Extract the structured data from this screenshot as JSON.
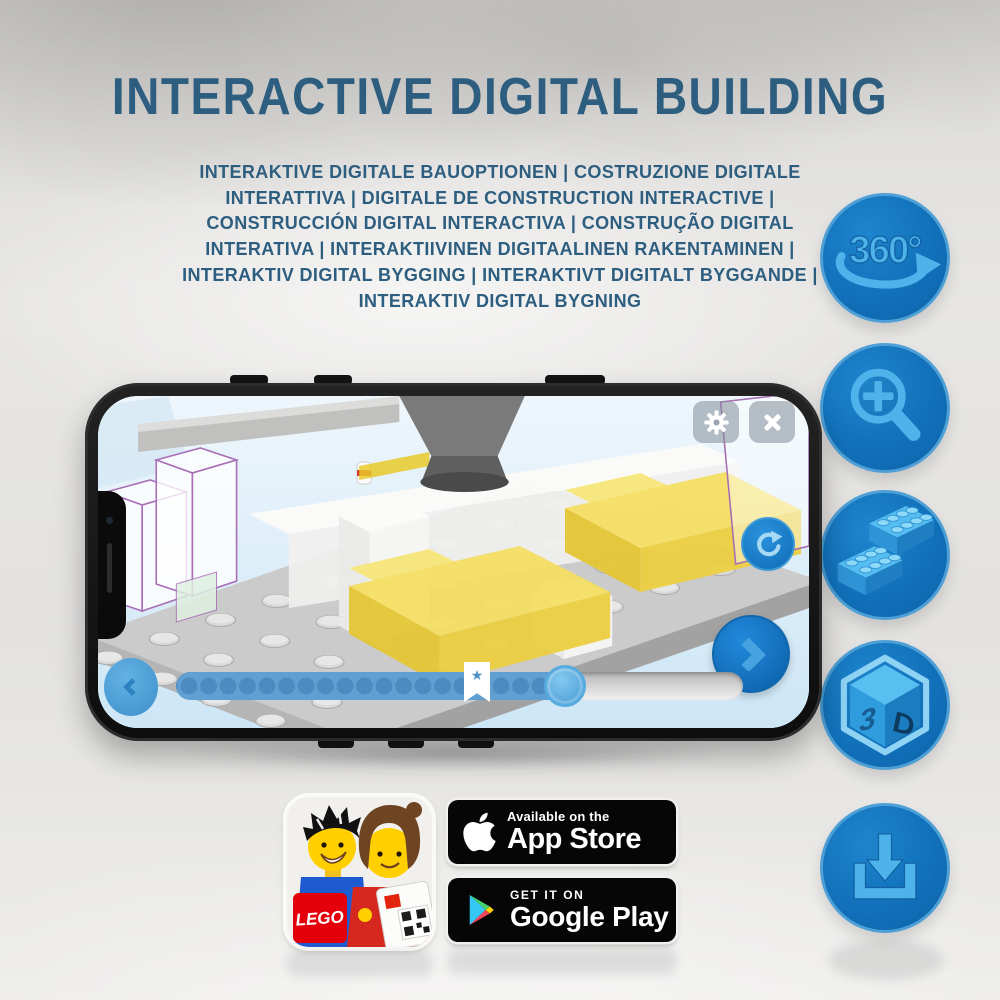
{
  "page": {
    "title": "INTERACTIVE DIGITAL BUILDING",
    "subtitle": "INTERAKTIVE DIGITALE BAUOPTIONEN | COSTRUZIONE DIGITALE INTERATTIVA | DIGITALE DE CONSTRUCTION INTERACTIVE | CONSTRUCCIÓN DIGITAL INTERACTIVA | CONSTRUÇÃO DIGITAL INTERATIVA | INTERAKTIIVINEN DIGITAALINEN RAKENTAMINEN | INTERAKTIV DIGITAL BYGGING | INTERAKTIVT DIGITALT BYGGANDE | INTERAKTIV DIGITAL BYGNING",
    "colors": {
      "heading_blue": "#2d5e80",
      "feature_circle_blue": "#1171ba",
      "feature_glyph_blue": "#4db3ea",
      "screen_sky_blue": "#dceefb",
      "brick_yellow": "#f2d94e"
    }
  },
  "features": {
    "rotation_badge_label": "360°",
    "cube_face_left": "3",
    "cube_face_right": "D"
  },
  "phone": {
    "slider_star": "★"
  },
  "store": {
    "lego_logo_text": "LEGO",
    "app_store": {
      "tagline": "Available on the",
      "name": "App Store"
    },
    "google_play": {
      "tagline": "GET IT ON",
      "name": "Google Play"
    }
  }
}
